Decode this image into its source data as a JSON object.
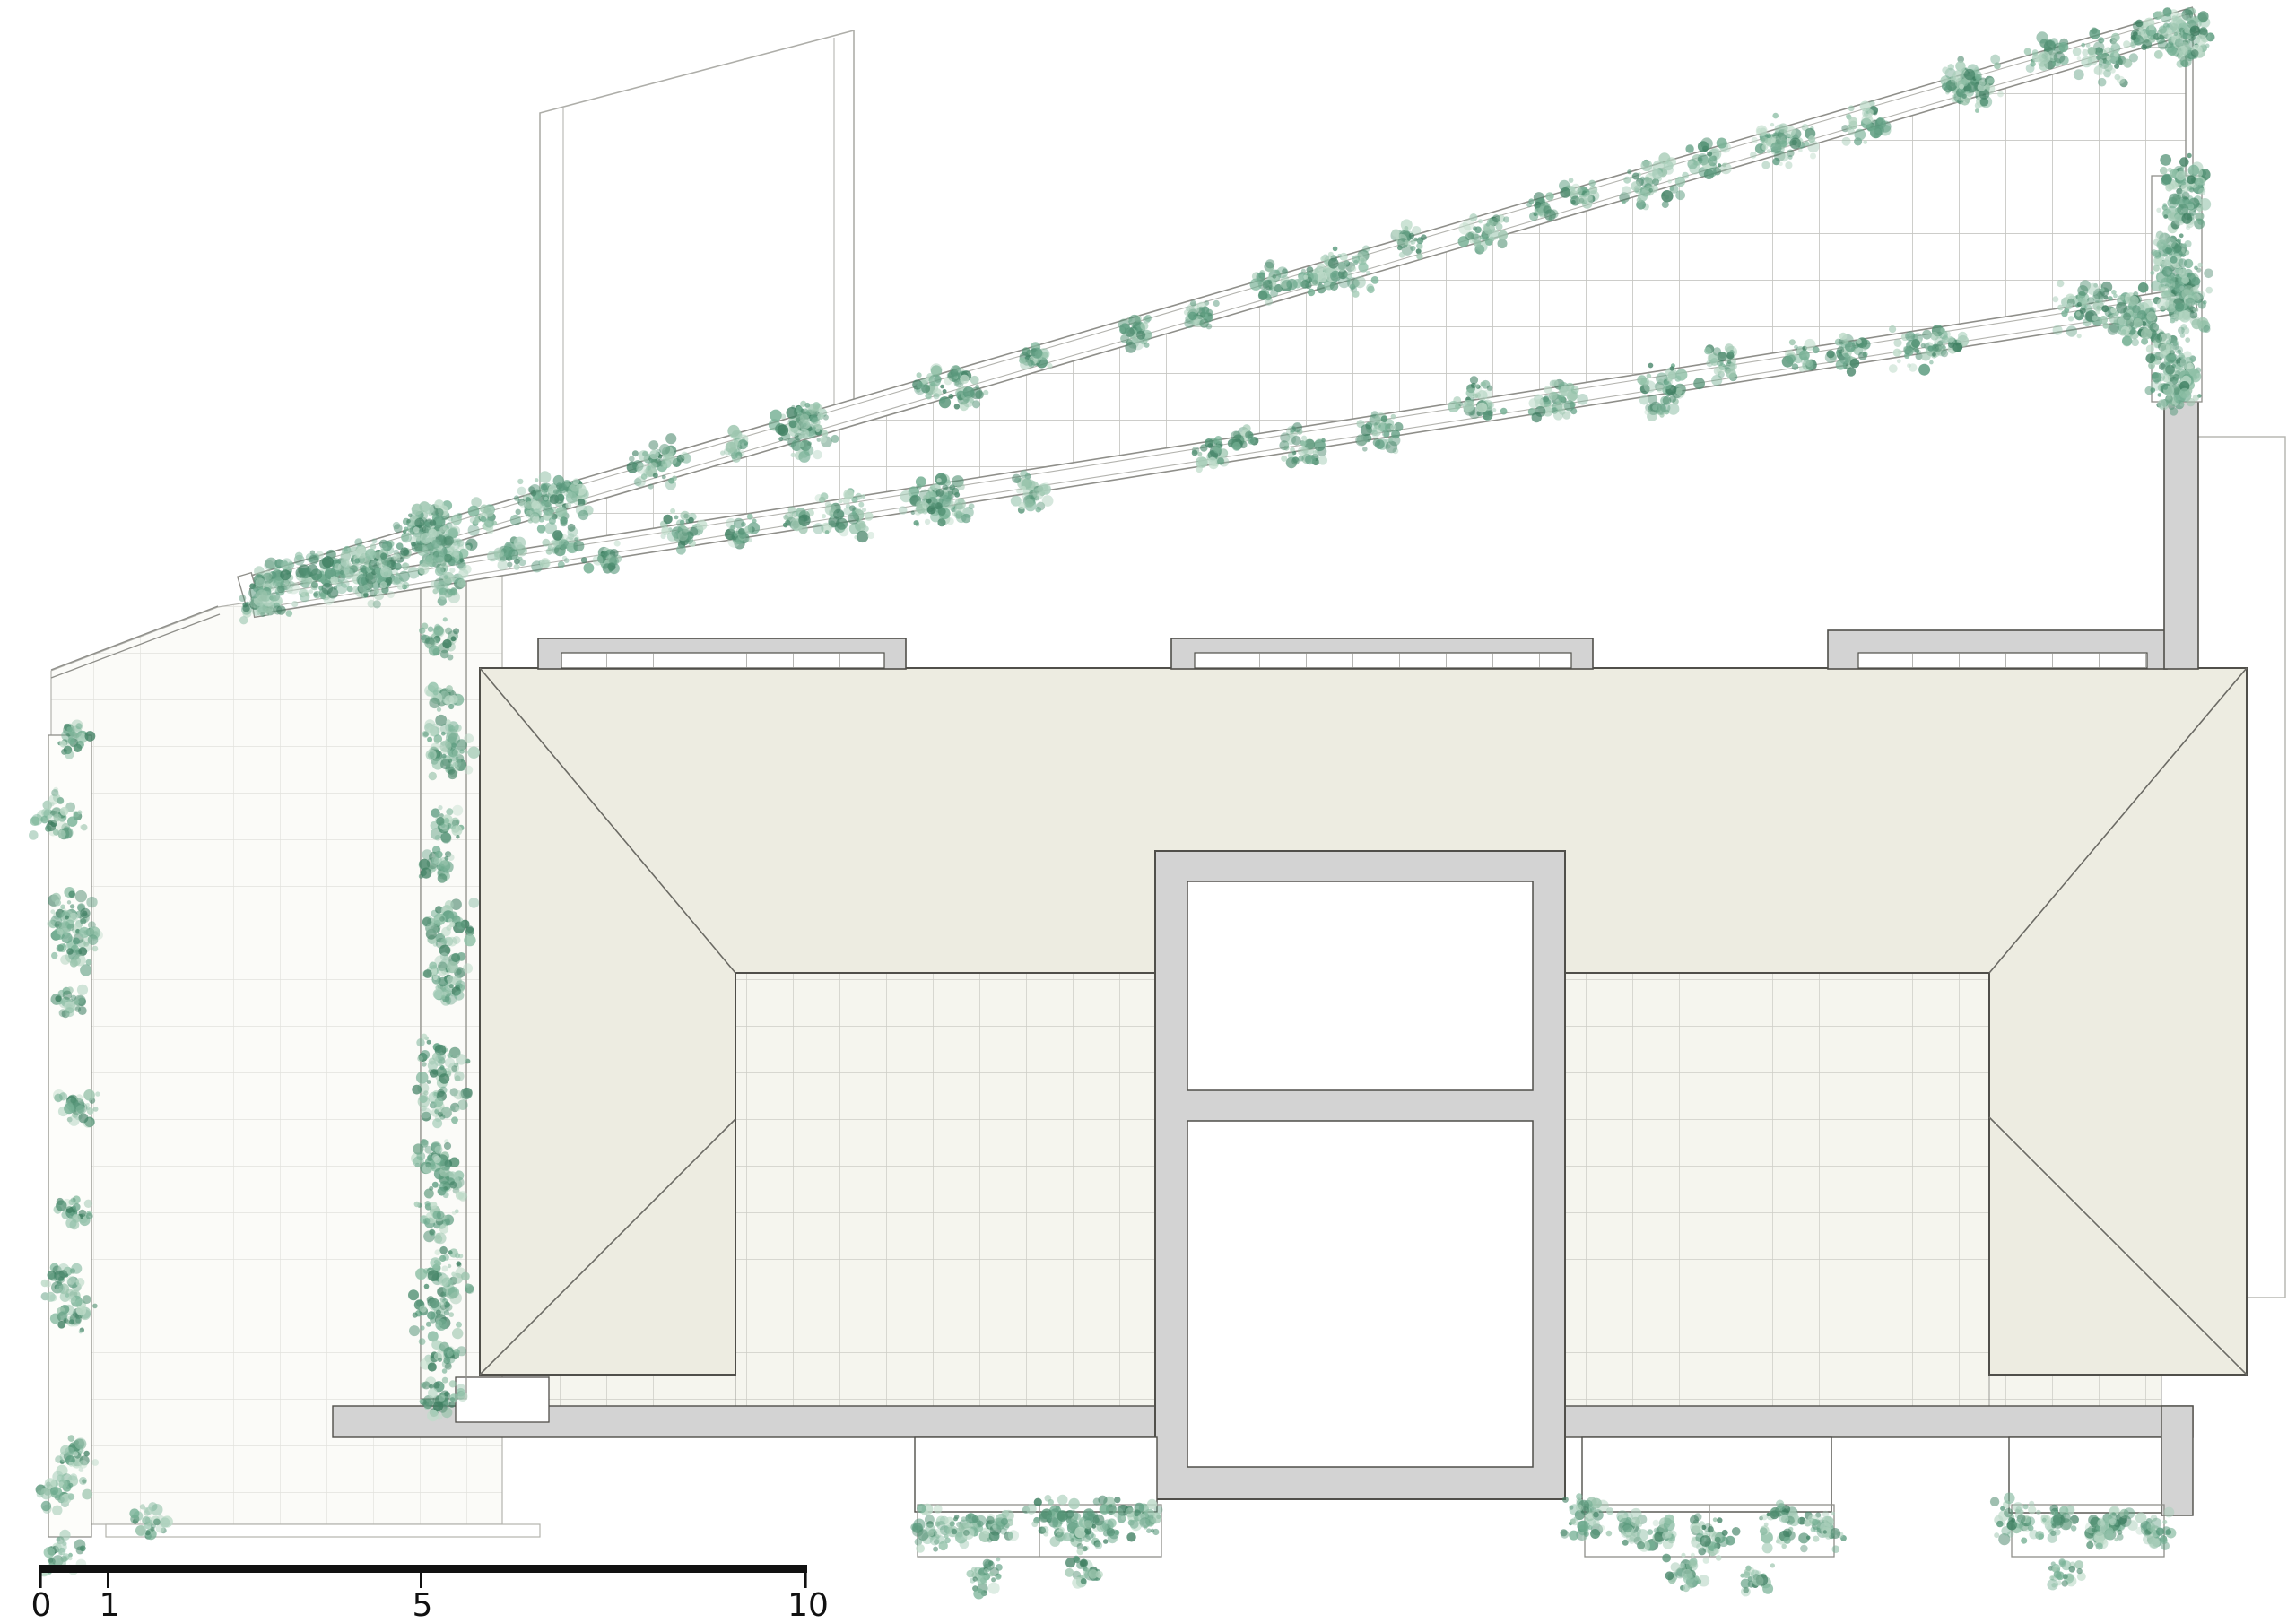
{
  "scale_bar": {
    "labels": [
      "0",
      "1",
      "5",
      "10"
    ]
  },
  "palette": {
    "foliage": [
      "#a9ceba",
      "#8fc0a7",
      "#74af93",
      "#5d9c80",
      "#bedbc9",
      "#4f8f71",
      "#9bc4ad"
    ],
    "foliage_dark": "#3f7f62",
    "roof_fill": "#edece1",
    "concrete_fill": "#d3d3d3",
    "outline_dark": "#504f4a",
    "outline_mid": "#8f8f8a",
    "outline_light": "#b3b3ae",
    "terrace_grid_line": "#e2e2dd",
    "terrace_bg": "#fbfbf8",
    "trellis_grid_line": "#c6c6c2",
    "courtyard_grid_line": "#cdcdc5",
    "courtyard_bg": "#f5f5ee",
    "scale_bar_color": "#111111"
  }
}
